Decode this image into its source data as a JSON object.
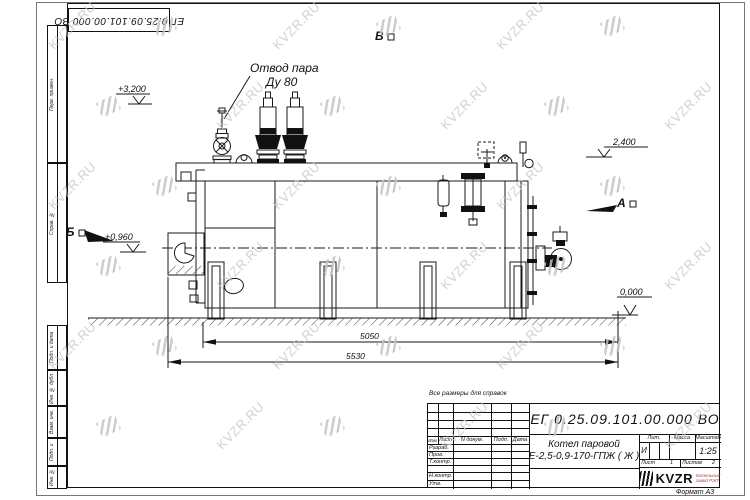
{
  "watermark": {
    "text": "KVZR.RU"
  },
  "top_stamp": {
    "text": "ЕГ 0.25.09.101.00.000  ВО"
  },
  "side_labels": [
    "Перв. примен.",
    "Справ. №",
    "Подп. и дата",
    "Инв. № дубл.",
    "Взам. инв. №",
    "Подп. и дата",
    "Инв. № подл."
  ],
  "drawing": {
    "labels": {
      "steam_outlet_line1": "Отвод пара",
      "steam_outlet_line2": "Ду 80",
      "view_v": "В",
      "view_a": "А",
      "view_b": "Б",
      "elev_3200": "+3,200",
      "elev_2400": "2,400",
      "elev_0960": "+0,960",
      "elev_0000": "0,000",
      "dim_5050": "5050",
      "dim_5530": "5530"
    }
  },
  "note": "Все размеры для справок",
  "title_block": {
    "designation": "ЕГ 0.25.09.101.00.000  ВО",
    "name_line1": "Котел паровой",
    "name_line2": "Е-2,5-0,9-170-ГПЖ ( Ж )",
    "header_cols": [
      "Изм.",
      "Лист",
      "N докум.",
      "Подп.",
      "Дата"
    ],
    "rows": [
      "Разраб.",
      "Пров.",
      "Т.контр.",
      "Н.контр.",
      "Утв."
    ],
    "lit_label": "Лит.",
    "lit_value": "И",
    "mass_label": "Масса",
    "scale_label": "Масштаб",
    "scale_value": "1:25",
    "sheet_label": "Лист",
    "sheet_value": "1",
    "sheets_label": "Листов",
    "sheets_value": "2",
    "company_logo": "KVZR",
    "company_name_line1": "Котельный",
    "company_name_line2": "завод РЭП",
    "format": "Формат А3"
  }
}
